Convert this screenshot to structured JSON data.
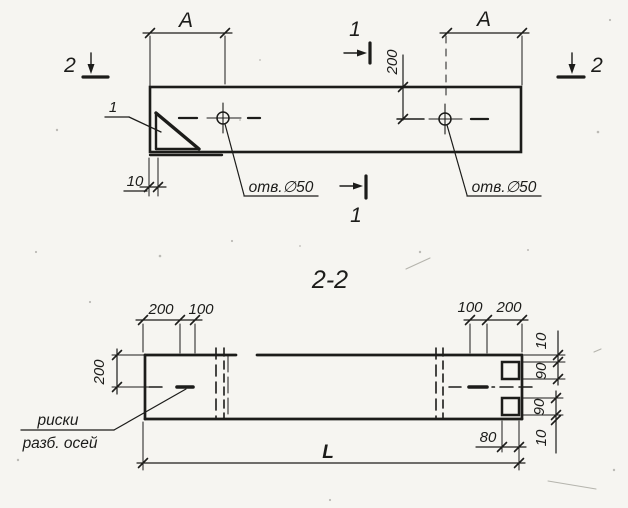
{
  "meta": {
    "paper_color": "#f6f5f1",
    "ink_color": "#1c1c1a",
    "drawing_type": "structural element, plan and section views"
  },
  "plan": {
    "cut1_top_label": "1",
    "cut1_bottom_label": "1",
    "cut2_left_label": "2",
    "cut2_right_label": "2",
    "dim_a_left": "A",
    "dim_a_right": "A",
    "dim_hole_offset": "200",
    "dim_end_offset": "10",
    "detail_ref": "1",
    "hole_left_label": "отв.∅50",
    "hole_right_label": "отв.∅50"
  },
  "section": {
    "title": "2-2",
    "dim_height": "200",
    "dims_top_left": [
      "200",
      "100"
    ],
    "dims_top_right": [
      "100",
      "200"
    ],
    "dims_right": [
      "10",
      "90",
      "90",
      "10"
    ],
    "dim_notch_depth": "80",
    "dim_length": "L",
    "note_line1": "риски",
    "note_line2": "разб. осей"
  }
}
